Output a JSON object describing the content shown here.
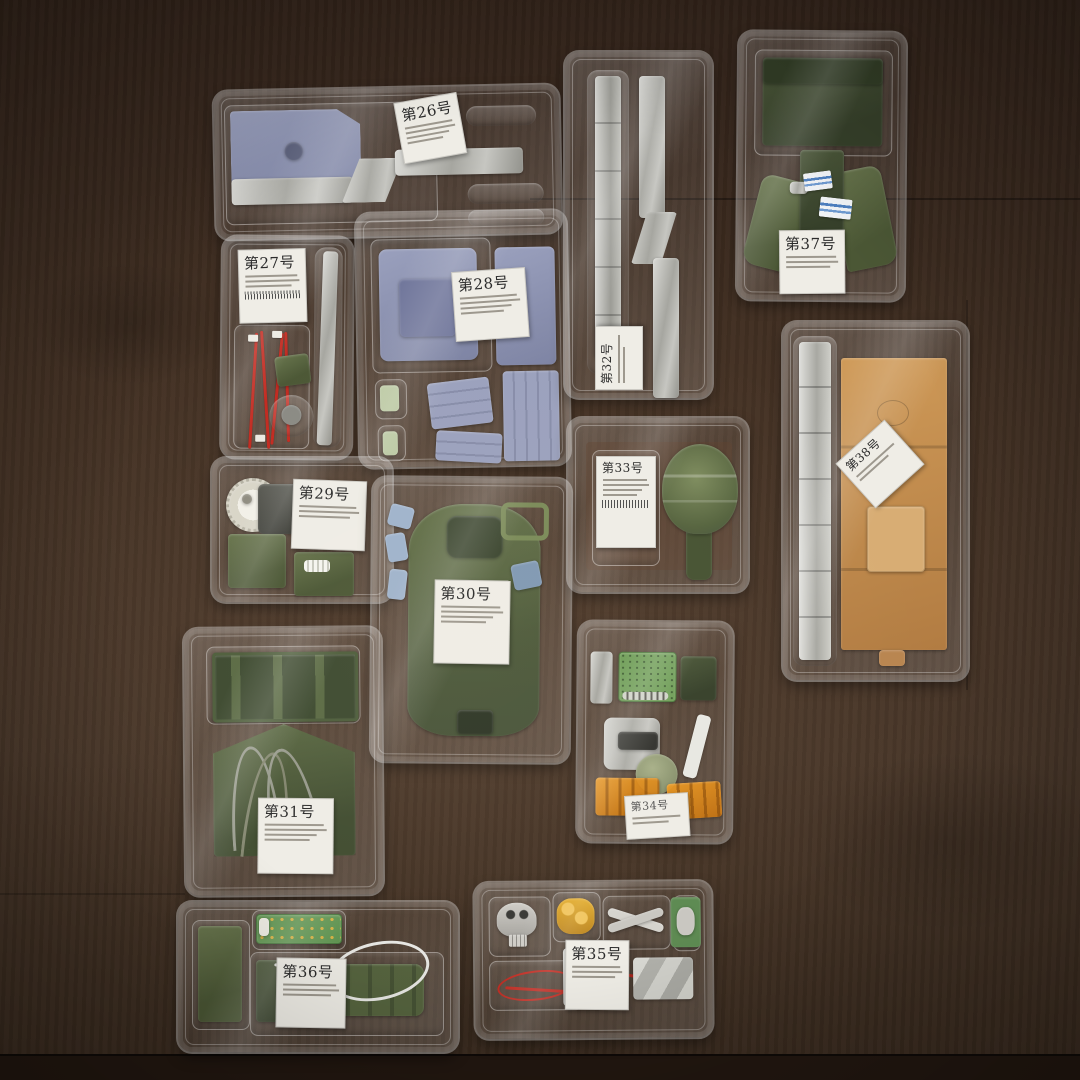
{
  "scene": {
    "setting": "clear plastic model-kit blister trays on a dark brown wooden table",
    "accent_colors": {
      "olive_part": "#55633e",
      "bluegray_part": "#8f94b4",
      "diecast_metal": "#c0c0bc",
      "cardboard": "#c18a4a",
      "pcb_green": "#6f9c5a",
      "orange_part": "#e08818",
      "wire_red": "#c22a20",
      "wood": "#3f2e22",
      "label_card": "#efede6"
    }
  },
  "trays": [
    {
      "label": "第26号"
    },
    {
      "label": "第27号"
    },
    {
      "label": "第28号"
    },
    {
      "label": "第29号"
    },
    {
      "label": "第30号"
    },
    {
      "label": "第31号"
    },
    {
      "label": "第32号"
    },
    {
      "label": "第33号"
    },
    {
      "label": "第34号"
    },
    {
      "label": "第35号"
    },
    {
      "label": "第36号"
    },
    {
      "label": "第37号"
    },
    {
      "label": "第38号"
    }
  ]
}
